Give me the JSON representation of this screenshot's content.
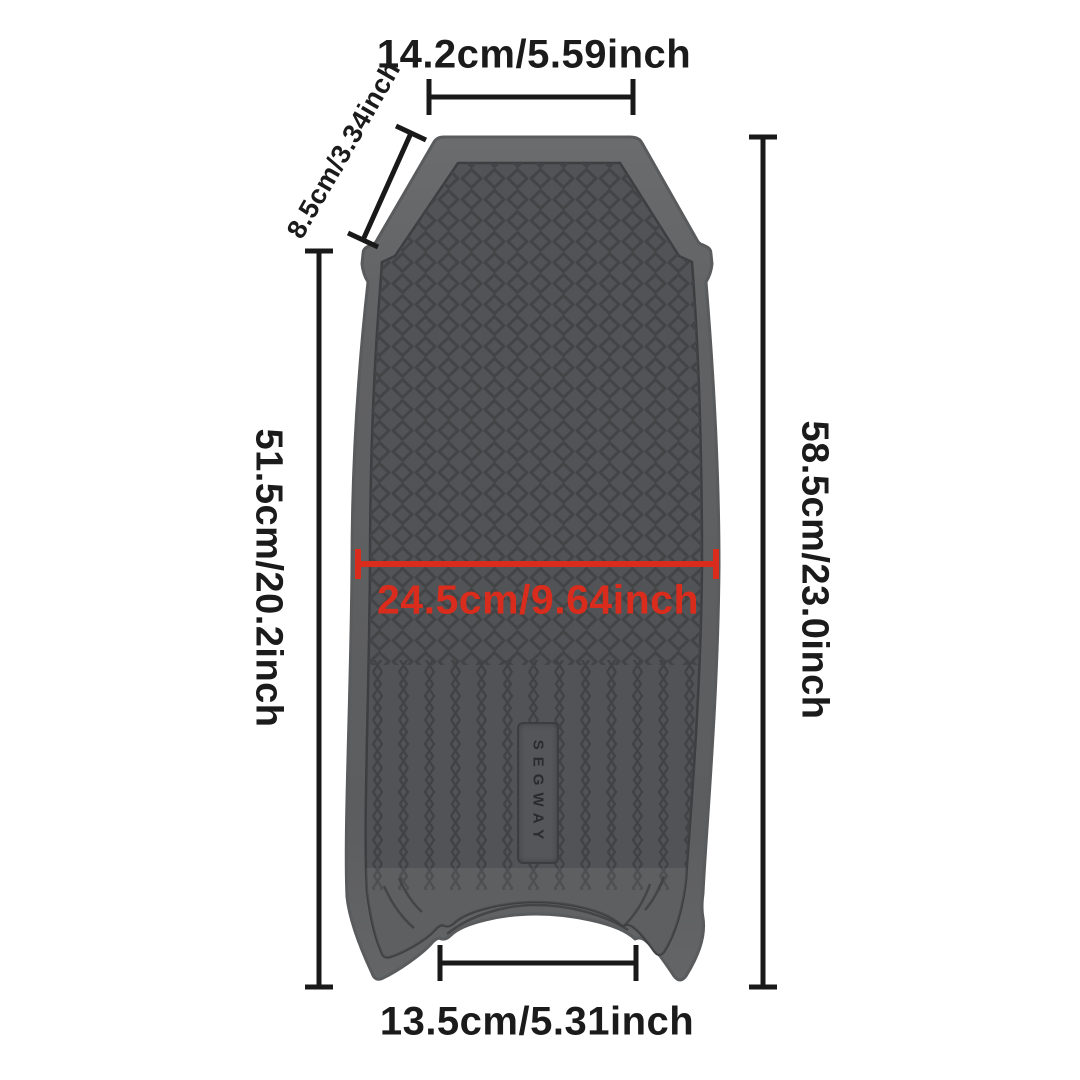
{
  "page": {
    "background": "#ffffff"
  },
  "illustration": {
    "brand_plate_label": "SEGWAY",
    "mat_base_color": "#5a5b5d",
    "mat_edge_color": "#67686a",
    "mat_texture_color": "#3f4042"
  },
  "dimensions": {
    "top_width": "14.2cm/5.59inch",
    "upper_side": "8.5cm/3.34inch",
    "left_height": "51.5cm/20.2inch",
    "right_height": "58.5cm/23.0inch",
    "middle_width": "24.5cm/9.64inch",
    "bottom_width": "13.5cm/5.31inch",
    "middle_width_color": "#da2c1c",
    "line_color": "#191919"
  }
}
